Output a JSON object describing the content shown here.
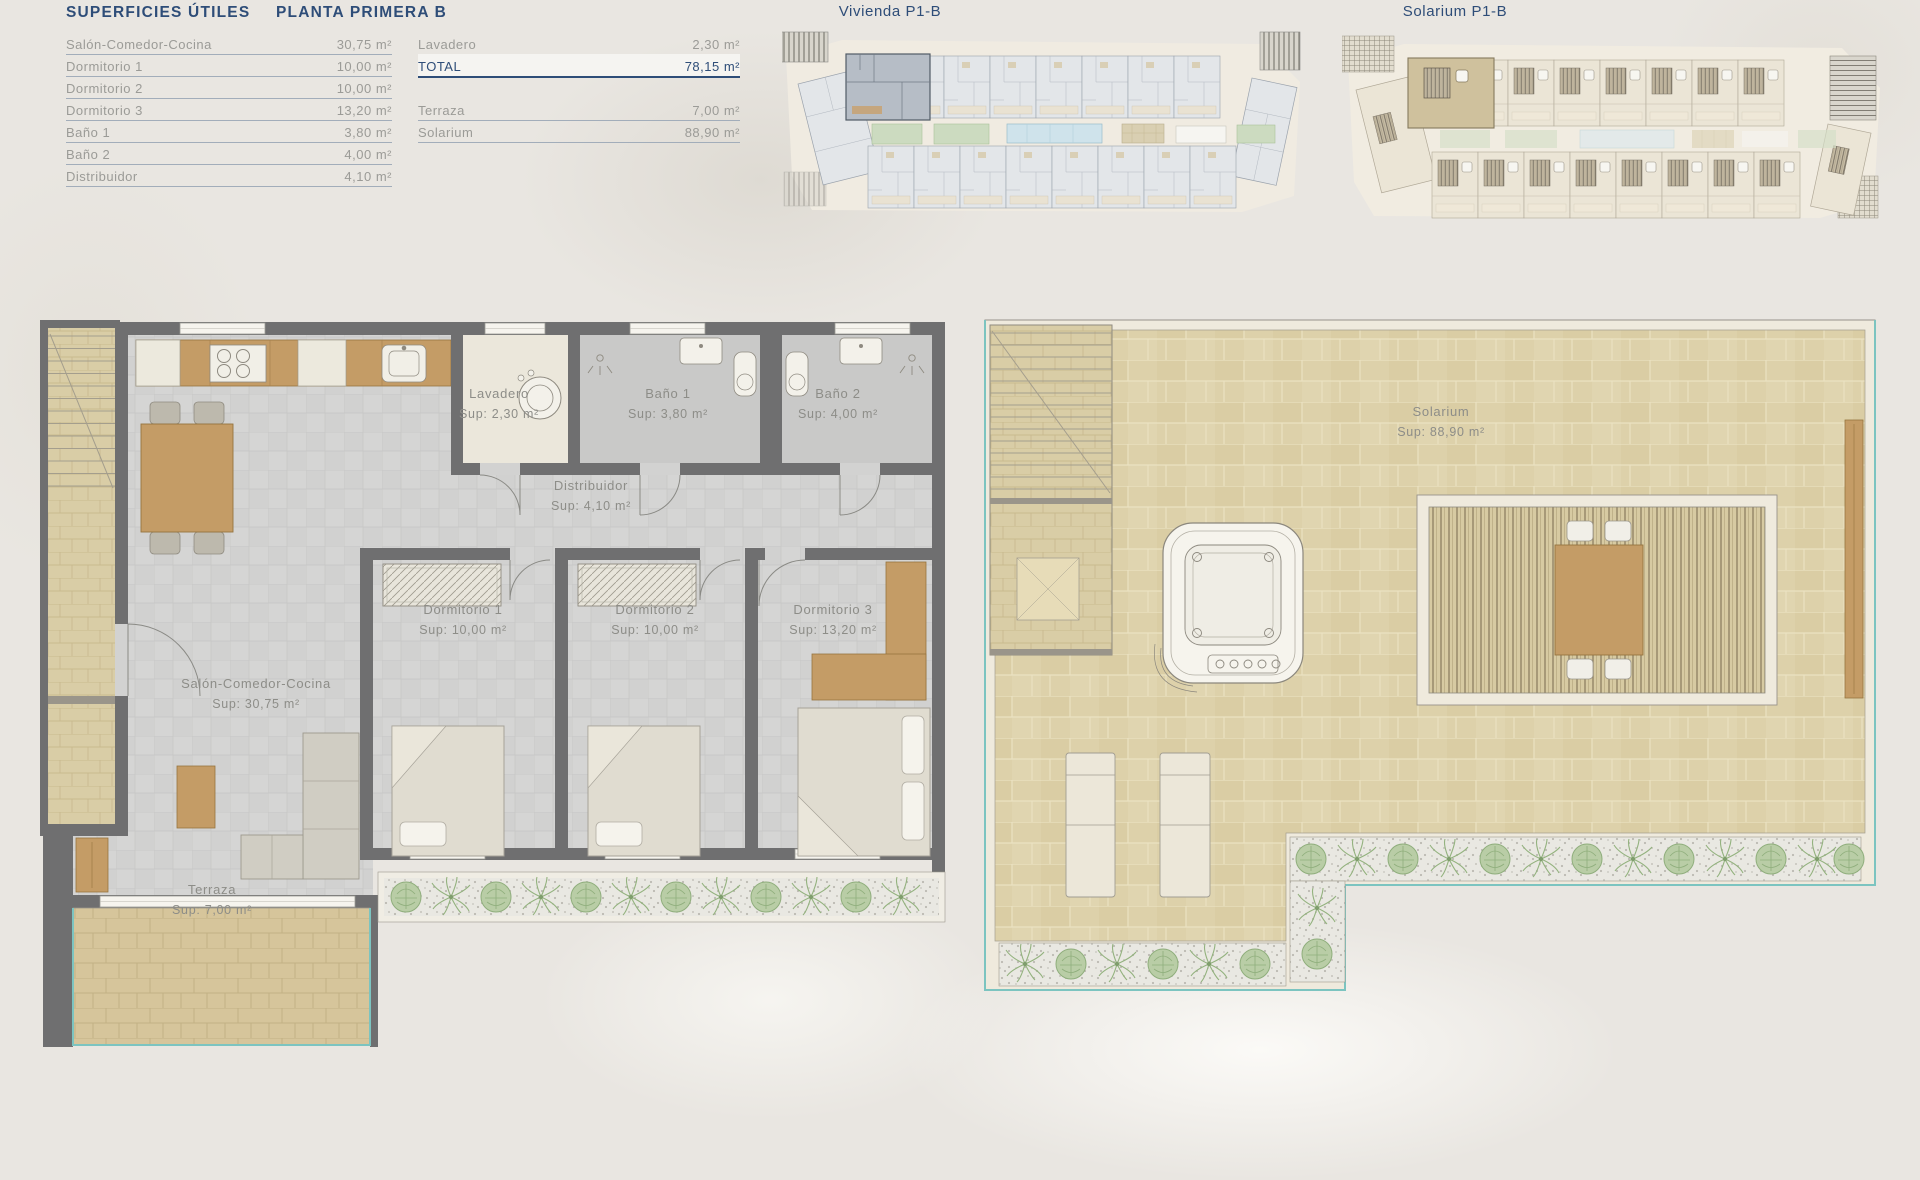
{
  "colors": {
    "accent_blue": "#2e4d78",
    "text_gray": "#9b9b97",
    "label_gray": "#8d8d88",
    "teal_border": "#7cc4c0",
    "wall_gray": "#6f6f70",
    "wood": "#c49c66",
    "tan_tile": "#ddd1aa"
  },
  "legend": {
    "title": "SUPERFICIES ÚTILES",
    "floor_title": "PLANTA PRIMERA B",
    "col1": [
      {
        "label": "Salón-Comedor-Cocina",
        "value": "30,75 m²"
      },
      {
        "label": "Dormitorio 1",
        "value": "10,00 m²"
      },
      {
        "label": "Dormitorio 2",
        "value": "10,00 m²"
      },
      {
        "label": "Dormitorio 3",
        "value": "13,20 m²"
      },
      {
        "label": "Baño 1",
        "value": "3,80 m²"
      },
      {
        "label": "Baño 2",
        "value": "4,00 m²"
      },
      {
        "label": "Distribuidor",
        "value": "4,10 m²"
      }
    ],
    "col2": [
      {
        "label": "Lavadero",
        "value": "2,30 m²"
      },
      {
        "label": "TOTAL",
        "value": "78,15 m²"
      },
      {
        "label": "Terraza",
        "value": "7,00 m²"
      },
      {
        "label": "Solarium",
        "value": "88,90 m²"
      }
    ]
  },
  "overviews": {
    "vivienda_label": "Vivienda P1-B",
    "solarium_label": "Solarium P1-B"
  },
  "floorplan": {
    "rooms": [
      {
        "name": "Lavadero",
        "sup": "Sup: 2,30 m²"
      },
      {
        "name": "Baño 1",
        "sup": "Sup: 3,80 m²"
      },
      {
        "name": "Baño 2",
        "sup": "Sup: 4,00 m²"
      },
      {
        "name": "Distribuidor",
        "sup": "Sup: 4,10 m²"
      },
      {
        "name": "Dormitorio 1",
        "sup": "Sup: 10,00 m²"
      },
      {
        "name": "Dormitorio 2",
        "sup": "Sup: 10,00 m²"
      },
      {
        "name": "Dormitorio 3",
        "sup": "Sup: 13,20 m²"
      },
      {
        "name": "Salón-Comedor-Cocina",
        "sup": "Sup: 30,75 m²"
      },
      {
        "name": "Terraza",
        "sup": "Sup: 7,00 m²"
      }
    ]
  },
  "solarium_plan": {
    "name": "Solarium",
    "sup": "Sup: 88,90 m²"
  }
}
